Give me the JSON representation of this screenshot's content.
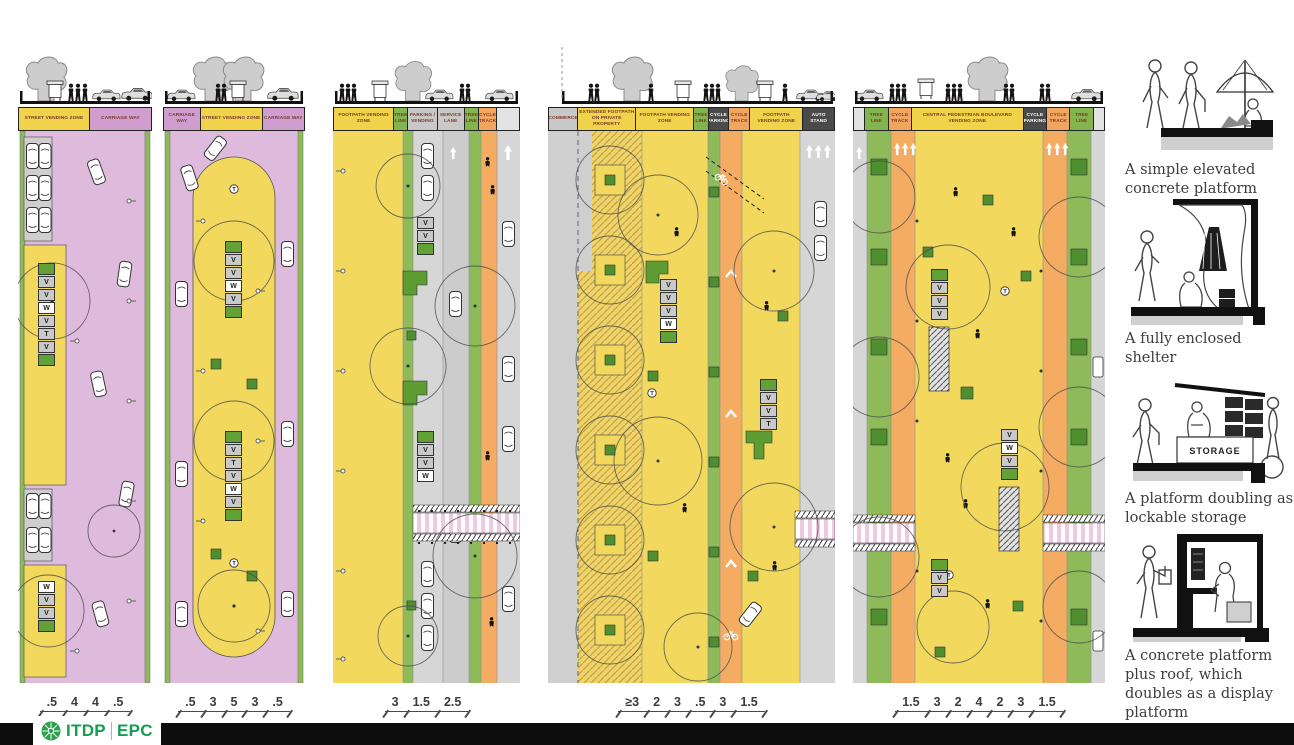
{
  "palette": {
    "carriageway_purple": "#debadd",
    "vending_yellow": "#f2d95e",
    "tree_green": "#8fba5a",
    "platform_green": "#4f8f2f",
    "cycle_orange": "#f4ab62",
    "lane_gray": "#d6d6d6",
    "stall_gray": "#c9c9c9",
    "crossing_pink": "#efc9e2",
    "dark_label": "#4a4a4a",
    "label_text": "#7b3b2b",
    "logo_green": "#169c55"
  },
  "glyphs": {
    "vendor": "V",
    "water": "W",
    "toilet": "T"
  },
  "panels": [
    {
      "labels": [
        {
          "text": "STREET VENDING ZONE",
          "bg": "#f0d24b",
          "fg": "#7b3b2b",
          "flex": "1.15"
        },
        {
          "text": "CARRIAGE WAY",
          "bg": "#cf9ecf",
          "fg": "#7b3b2b",
          "flex": "1"
        }
      ],
      "dims": [
        ".5",
        "4",
        "4",
        ".5"
      ],
      "stallsA": [
        {
          "t": "",
          "bg": "#61a135"
        },
        {
          "t": "V",
          "bg": "#c9c9c9"
        },
        {
          "t": "V",
          "bg": "#c9c9c9"
        },
        {
          "t": "W",
          "bg": "#ffffff"
        },
        {
          "t": "V",
          "bg": "#c9c9c9"
        },
        {
          "t": "T",
          "bg": "#c9c9c9"
        },
        {
          "t": "V",
          "bg": "#c9c9c9"
        },
        {
          "t": "",
          "bg": "#61a135"
        }
      ],
      "stallsB": [
        {
          "t": "W",
          "bg": "#ffffff"
        },
        {
          "t": "V",
          "bg": "#c9c9c9"
        },
        {
          "t": "V",
          "bg": "#c9c9c9"
        },
        {
          "t": "",
          "bg": "#61a135"
        }
      ]
    },
    {
      "labels": [
        {
          "text": "CARRIAGE WAY",
          "bg": "#cf9ecf",
          "fg": "#7b3b2b",
          "flex": "0.85"
        },
        {
          "text": "STREET VENDING ZONE",
          "bg": "#f0d24b",
          "fg": "#7b3b2b",
          "flex": "1.5"
        },
        {
          "text": "CARRIAGE WAY",
          "bg": "#cf9ecf",
          "fg": "#7b3b2b",
          "flex": "1"
        }
      ],
      "dims": [
        ".5",
        "3",
        "5",
        "3",
        ".5"
      ],
      "stallsA": [
        {
          "t": "",
          "bg": "#61a135"
        },
        {
          "t": "V",
          "bg": "#c9c9c9"
        },
        {
          "t": "V",
          "bg": "#c9c9c9"
        },
        {
          "t": "W",
          "bg": "#ffffff"
        },
        {
          "t": "V",
          "bg": "#c9c9c9"
        },
        {
          "t": "",
          "bg": "#61a135"
        }
      ],
      "stallsB": [
        {
          "t": "",
          "bg": "#61a135"
        },
        {
          "t": "V",
          "bg": "#c9c9c9"
        },
        {
          "t": "T",
          "bg": "#c9c9c9"
        },
        {
          "t": "V",
          "bg": "#c9c9c9"
        },
        {
          "t": "W",
          "bg": "#ffffff"
        },
        {
          "t": "V",
          "bg": "#c9c9c9"
        },
        {
          "t": "",
          "bg": "#61a135"
        }
      ]
    },
    {
      "labels": [
        {
          "text": "FOOTPATH VENDING ZONE",
          "bg": "#f0d24b",
          "fg": "#7b3b2b",
          "flex": "2.6"
        },
        {
          "text": "TREE LINE",
          "bg": "#82b54e",
          "fg": "#7b3b2b",
          "flex": "0.5"
        },
        {
          "text": "PARKING / VENDING",
          "bg": "#c8c8c8",
          "fg": "#7b3b2b",
          "flex": "1.2"
        },
        {
          "text": "SERVICE LANE",
          "bg": "#c8c8c8",
          "fg": "#7b3b2b",
          "flex": "1.1"
        },
        {
          "text": "TREE LINE",
          "bg": "#82b54e",
          "fg": "#7b3b2b",
          "flex": "0.5"
        },
        {
          "text": "CYCLE TRACK",
          "bg": "#f2a55f",
          "fg": "#7b3b2b",
          "flex": "0.7"
        },
        {
          "text": "",
          "bg": "#e3e3e3",
          "fg": "#7b3b2b",
          "flex": "0.9"
        }
      ],
      "dims": [
        "3",
        "1.5",
        "2.5"
      ],
      "stallsA": [
        {
          "t": "V",
          "bg": "#c9c9c9"
        },
        {
          "t": "V",
          "bg": "#c9c9c9"
        },
        {
          "t": "",
          "bg": "#61a135"
        }
      ],
      "stallsB": [
        {
          "t": "",
          "bg": "#61a135"
        },
        {
          "t": "V",
          "bg": "#c9c9c9"
        },
        {
          "t": "V",
          "bg": "#c9c9c9"
        },
        {
          "t": "W",
          "bg": "#ffffff"
        }
      ]
    },
    {
      "labels": [
        {
          "text": "COMMERCE",
          "bg": "#c8c8c8",
          "fg": "#7b3b2b",
          "flex": "1"
        },
        {
          "text": "EXTENDED FOOTPATH ON PRIVATE PROPERTY",
          "bg": "#f0d24b",
          "fg": "#7b3b2b",
          "flex": "2.1"
        },
        {
          "text": "FOOTPATH VENDING ZONE",
          "bg": "#f0d24b",
          "fg": "#7b3b2b",
          "flex": "2.1"
        },
        {
          "text": "TREE LINE",
          "bg": "#82b54e",
          "fg": "#7b3b2b",
          "flex": "0.45"
        },
        {
          "text": "CYCLE PARKING",
          "bg": "#4a4a4a",
          "fg": "#ffffff",
          "flex": "0.65"
        },
        {
          "text": "CYCLE TRACK",
          "bg": "#f2a55f",
          "fg": "#7b3b2b",
          "flex": "0.7"
        },
        {
          "text": "FOOTPATH VENDING ZONE",
          "bg": "#f0d24b",
          "fg": "#7b3b2b",
          "flex": "1.9"
        },
        {
          "text": "AUTO STAND",
          "bg": "#4a4a4a",
          "fg": "#ffffff",
          "flex": "1.1"
        }
      ],
      "dims": [
        "≥3",
        "2",
        "3",
        ".5",
        "3",
        "1.5"
      ],
      "stallsA": [
        {
          "t": "V",
          "bg": "#c9c9c9"
        },
        {
          "t": "V",
          "bg": "#c9c9c9"
        },
        {
          "t": "V",
          "bg": "#c9c9c9"
        },
        {
          "t": "W",
          "bg": "#ffffff"
        },
        {
          "t": "",
          "bg": "#61a135"
        }
      ],
      "stallsB": [
        {
          "t": "",
          "bg": "#61a135"
        },
        {
          "t": "V",
          "bg": "#c9c9c9"
        },
        {
          "t": "V",
          "bg": "#c9c9c9"
        },
        {
          "t": "T",
          "bg": "#c9c9c9"
        }
      ]
    },
    {
      "labels": [
        {
          "text": "",
          "bg": "#e3e3e3",
          "fg": "#7b3b2b",
          "flex": "0.3"
        },
        {
          "text": "TREE LINE",
          "bg": "#82b54e",
          "fg": "#7b3b2b",
          "flex": "0.75"
        },
        {
          "text": "CYCLE TRACK",
          "bg": "#f2a55f",
          "fg": "#7b3b2b",
          "flex": "0.75"
        },
        {
          "text": "CENTRAL PEDESTRIAN BOULEVARD VENDING ZONE",
          "bg": "#f0d24b",
          "fg": "#7b3b2b",
          "flex": "4"
        },
        {
          "text": "CYCLE PARKING",
          "bg": "#4a4a4a",
          "fg": "#ffffff",
          "flex": "0.75"
        },
        {
          "text": "CYCLE TRACK",
          "bg": "#f2a55f",
          "fg": "#7b3b2b",
          "flex": "0.75"
        },
        {
          "text": "TREE LINE",
          "bg": "#82b54e",
          "fg": "#7b3b2b",
          "flex": "0.75"
        },
        {
          "text": "",
          "bg": "#e3e3e3",
          "fg": "#7b3b2b",
          "flex": "0.3"
        }
      ],
      "dims": [
        "1.5",
        "3",
        "2",
        "4",
        "2",
        "3",
        "1.5"
      ],
      "stallsA": [
        {
          "t": "",
          "bg": "#61a135"
        },
        {
          "t": "V",
          "bg": "#c9c9c9"
        },
        {
          "t": "V",
          "bg": "#c9c9c9"
        },
        {
          "t": "V",
          "bg": "#c9c9c9"
        }
      ],
      "stallsB": [
        {
          "t": "V",
          "bg": "#c9c9c9"
        },
        {
          "t": "W",
          "bg": "#ffffff"
        },
        {
          "t": "V",
          "bg": "#c9c9c9"
        },
        {
          "t": "",
          "bg": "#61a135"
        }
      ],
      "stallsC": [
        {
          "t": "",
          "bg": "#61a135"
        },
        {
          "t": "V",
          "bg": "#c9c9c9"
        },
        {
          "t": "V",
          "bg": "#c9c9c9"
        }
      ]
    }
  ],
  "sidebar": {
    "storage_label": "STORAGE",
    "items": [
      {
        "caption": "A simple elevated concrete platform"
      },
      {
        "caption": "A fully enclosed shelter"
      },
      {
        "caption": "A platform doubling as lockable storage"
      },
      {
        "caption": "A concrete platform plus roof, which doubles as a display platform"
      }
    ]
  },
  "footer": {
    "itdp": "ITDP",
    "epc": "EPC"
  }
}
